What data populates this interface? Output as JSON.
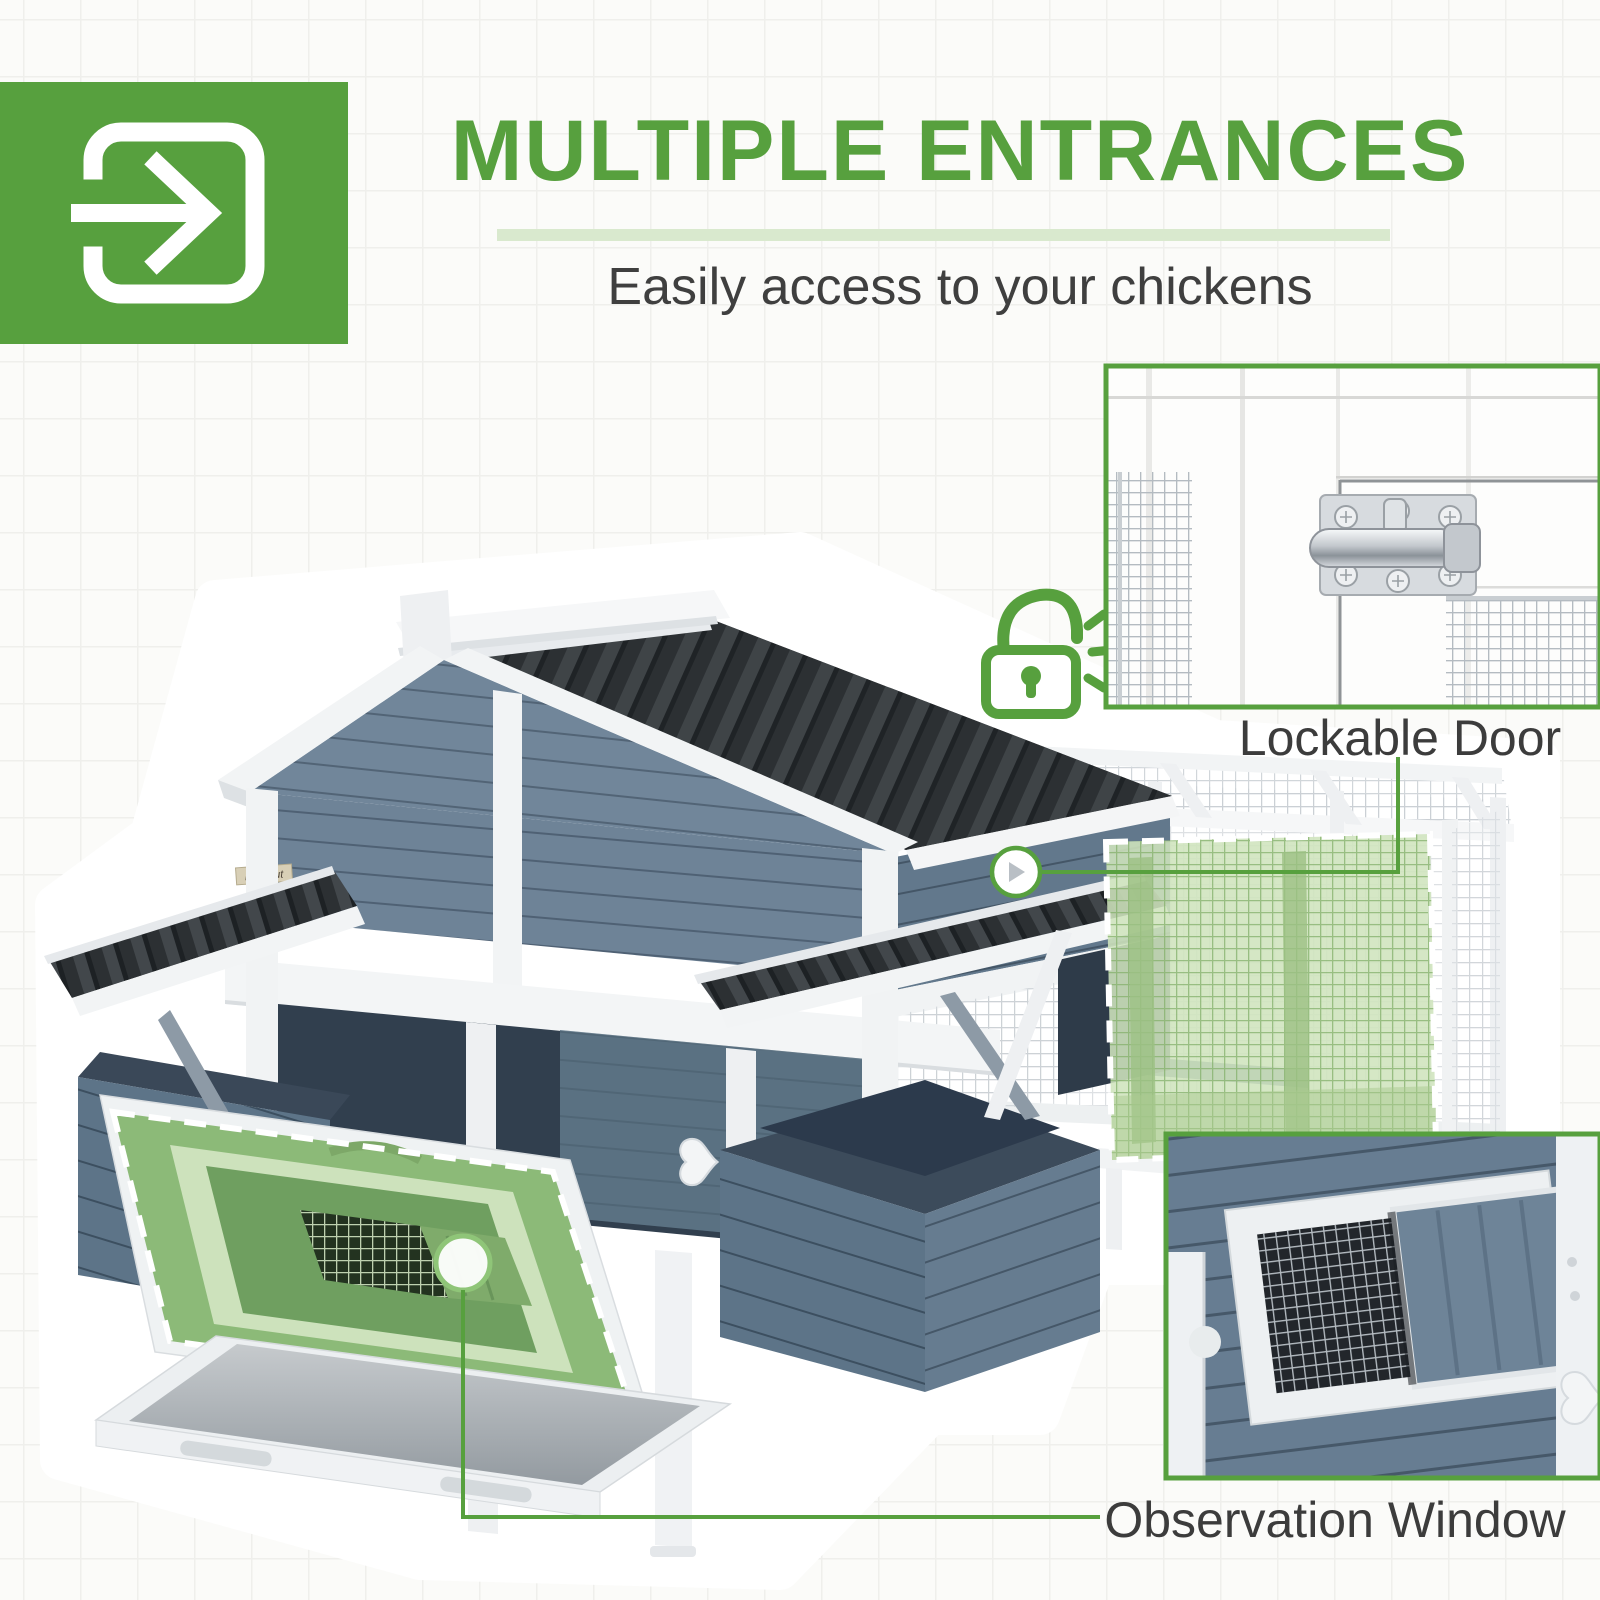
{
  "colors": {
    "accent": "#57a03e",
    "accent-soft": "#d9e9ce",
    "highlight-green": "#cfe4bd",
    "door-green": "#6f9f60",
    "coop-blue": "#6e8397",
    "coop-blue-dark": "#5d7488",
    "interior-dark": "#313f4e",
    "roof-black": "#2c3033",
    "wood-white": "#f2f4f5"
  },
  "header": {
    "icon": "enter-door-arrow-icon",
    "title": "MULTIPLE ENTRANCES",
    "subtitle": "Easily access to your chickens"
  },
  "callouts": {
    "lockable_door": {
      "label": "Lockable Door"
    },
    "observation_window": {
      "label": "Observation Window"
    }
  },
  "icons": {
    "entrance": "enter-door-arrow-icon",
    "padlock": "unlocked-padlock-icon"
  },
  "product": {
    "brand_label": "PawHut"
  }
}
